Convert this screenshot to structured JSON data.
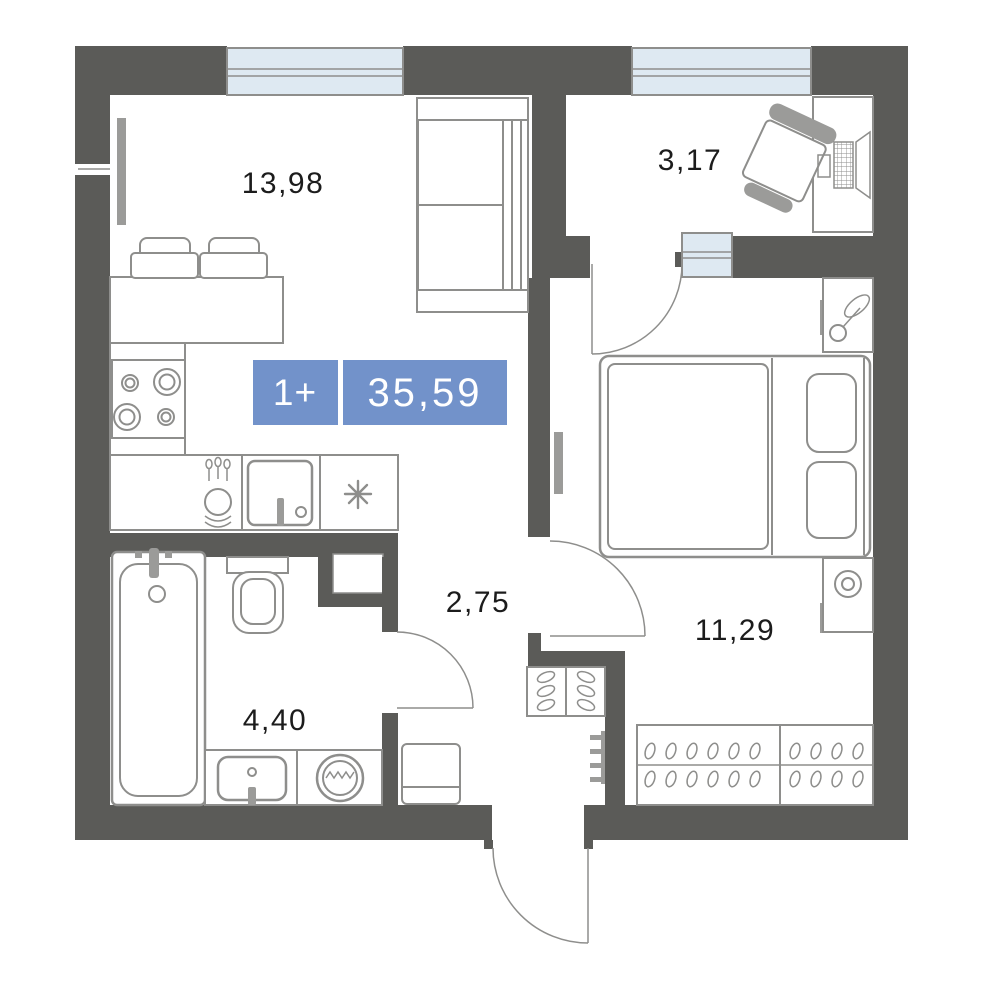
{
  "plan": {
    "badge": {
      "type_label": "1+",
      "total_area": "35,59",
      "background_color": "#7292CA",
      "text_color": "#FFFFFF"
    },
    "rooms": [
      {
        "name": "living-kitchen",
        "area_label": "13,98"
      },
      {
        "name": "loggia",
        "area_label": "3,17"
      },
      {
        "name": "hallway",
        "area_label": "2,75"
      },
      {
        "name": "bedroom",
        "area_label": "11,29"
      },
      {
        "name": "bathroom",
        "area_label": "4,40"
      }
    ],
    "colors": {
      "wall": "#5B5B58",
      "window_glass": "#DEE9F2",
      "furniture_line": "#8E8E8C",
      "radiator": "#9B9B99",
      "label_text": "#1C1C1C"
    }
  }
}
